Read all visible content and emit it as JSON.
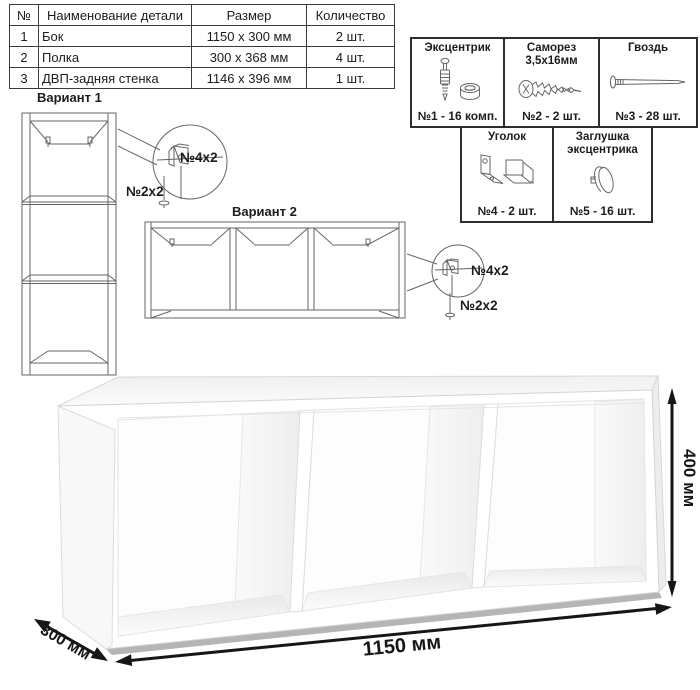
{
  "parts_table": {
    "headers": [
      "№",
      "Наименование детали",
      "Размер",
      "Количество"
    ],
    "rows": [
      {
        "num": "1",
        "name": "Бок",
        "size": "1150 х 300 мм",
        "qty": "2 шт."
      },
      {
        "num": "2",
        "name": "Полка",
        "size": "300 х 368 мм",
        "qty": "4 шт."
      },
      {
        "num": "3",
        "name": "ДВП-задняя стенка",
        "size": "1146 х 396 мм",
        "qty": "1 шт."
      }
    ]
  },
  "hardware": {
    "items": [
      {
        "title": "Эксцентрик",
        "label": "№1 - 16 комп.",
        "icon": "cam-lock-icon"
      },
      {
        "title": "Саморез 3,5х16мм",
        "label": "№2 - 2 шт.",
        "icon": "screw-icon"
      },
      {
        "title": "Гвоздь",
        "label": "№3 - 28 шт.",
        "icon": "nail-icon"
      },
      {
        "title": "Уголок",
        "label": "№4 - 2 шт.",
        "icon": "corner-bracket-icon"
      },
      {
        "title": "Заглушка эксцентрика",
        "label": "№5 - 16 шт.",
        "icon": "cap-icon"
      }
    ]
  },
  "variants": {
    "variant1": {
      "title": "Вариант 1",
      "bracket_label": "№4х2",
      "screw_label": "№2х2"
    },
    "variant2": {
      "title": "Вариант 2",
      "bracket_label": "№4х2",
      "screw_label": "№2х2"
    }
  },
  "dimensions": {
    "width": "1150 мм",
    "depth": "300 мм",
    "height": "400 мм"
  },
  "colors": {
    "outline_dark": "#2e2e2e",
    "drawing_line": "#666666",
    "dimension_text": "#161616"
  }
}
